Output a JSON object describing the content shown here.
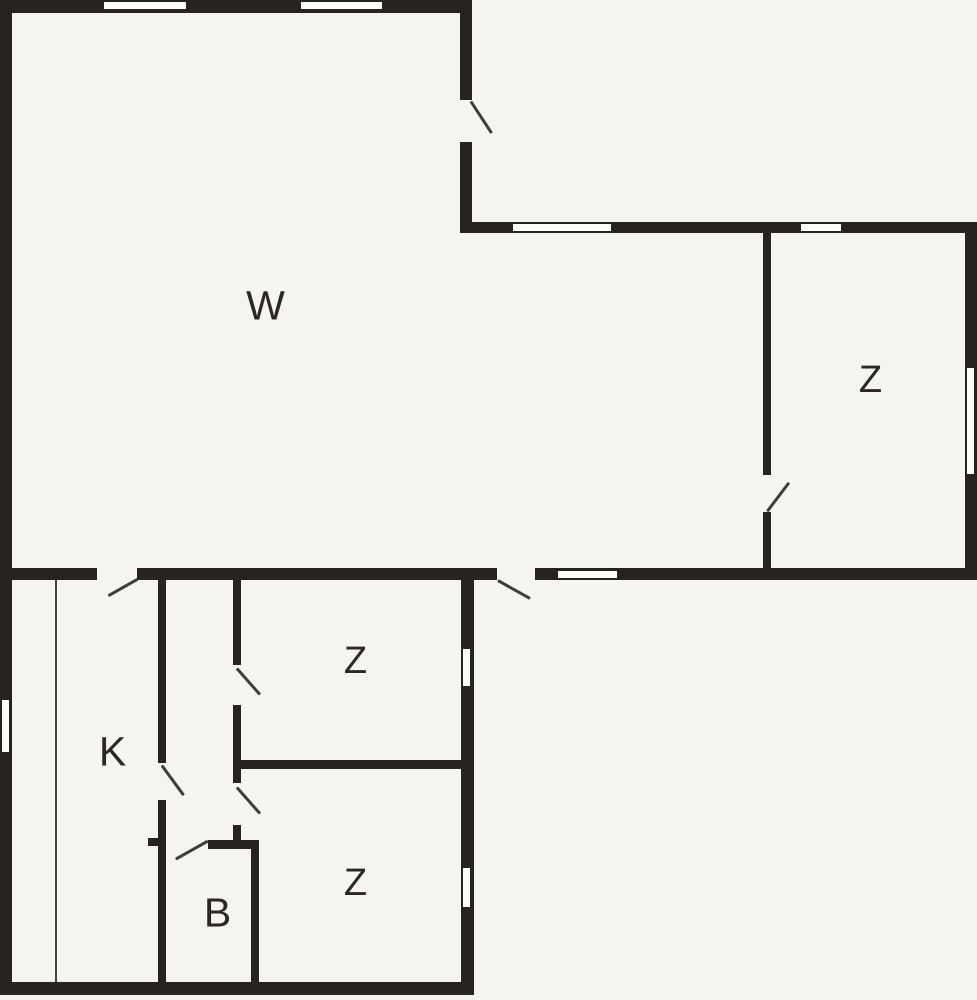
{
  "title": "Floor plan",
  "canvas": {
    "width": 977,
    "height": 1000
  },
  "colors": {
    "background": "#f5f4ef",
    "wall": "#272320",
    "window_fill": "#fdfdfa",
    "door_swing_line": "#3f3d38",
    "label_text": "#2b2723"
  },
  "rooms": [
    {
      "id": "w-room",
      "label": "W",
      "cx": 266,
      "cy": 306,
      "font_px": 41
    },
    {
      "id": "z-room-right",
      "label": "Z",
      "cx": 871,
      "cy": 380,
      "font_px": 38
    },
    {
      "id": "z-room-upper",
      "label": "Z",
      "cx": 356,
      "cy": 661,
      "font_px": 38
    },
    {
      "id": "z-room-lower",
      "label": "Z",
      "cx": 356,
      "cy": 883,
      "font_px": 38
    },
    {
      "id": "k-room",
      "label": "K",
      "cx": 113,
      "cy": 752,
      "font_px": 41
    },
    {
      "id": "b-room",
      "label": "B",
      "cx": 218,
      "cy": 913,
      "font_px": 41
    }
  ],
  "walls": [
    {
      "name": "top-exterior-wall",
      "x": 0,
      "y": 0,
      "w": 472,
      "h": 13
    },
    {
      "name": "left-exterior-wall",
      "x": 0,
      "y": 0,
      "w": 12,
      "h": 995
    },
    {
      "name": "bottom-exterior-wall",
      "x": 0,
      "y": 982,
      "w": 474,
      "h": 13
    },
    {
      "name": "lower-wing-right-wall",
      "x": 461,
      "y": 580,
      "w": 13,
      "h": 415
    },
    {
      "name": "entry-wall-above-door",
      "x": 460,
      "y": 0,
      "w": 12,
      "h": 100
    },
    {
      "name": "entry-wall-below-door",
      "x": 460,
      "y": 142,
      "w": 12,
      "h": 91
    },
    {
      "name": "right-wing-north-wall",
      "x": 460,
      "y": 222,
      "w": 517,
      "h": 11
    },
    {
      "name": "right-wing-east-wall",
      "x": 965,
      "y": 222,
      "w": 12,
      "h": 358
    },
    {
      "name": "south-wall-seg-1",
      "x": 12,
      "y": 568,
      "w": 85,
      "h": 12
    },
    {
      "name": "south-wall-seg-2",
      "x": 137,
      "y": 568,
      "w": 323,
      "h": 12
    },
    {
      "name": "south-wall-seg-3",
      "x": 460,
      "y": 568,
      "w": 37,
      "h": 12
    },
    {
      "name": "south-wall-seg-4",
      "x": 535,
      "y": 568,
      "w": 442,
      "h": 12
    },
    {
      "name": "z-right-partition-upper",
      "x": 763,
      "y": 233,
      "w": 8,
      "h": 242
    },
    {
      "name": "z-right-partition-lower",
      "x": 763,
      "y": 512,
      "w": 8,
      "h": 56
    },
    {
      "name": "hall-partition-top",
      "x": 233,
      "y": 580,
      "w": 8,
      "h": 85
    },
    {
      "name": "hall-partition-mid",
      "x": 233,
      "y": 705,
      "w": 8,
      "h": 78
    },
    {
      "name": "hall-partition-bottom",
      "x": 233,
      "y": 825,
      "w": 8,
      "h": 15
    },
    {
      "name": "z-divider-wall",
      "x": 241,
      "y": 760,
      "w": 220,
      "h": 9
    },
    {
      "name": "k-partition-upper",
      "x": 158,
      "y": 580,
      "w": 8,
      "h": 183
    },
    {
      "name": "k-b-partition-lower",
      "x": 158,
      "y": 800,
      "w": 8,
      "h": 185
    },
    {
      "name": "b-top-wall",
      "x": 208,
      "y": 840,
      "w": 51,
      "h": 9
    },
    {
      "name": "b-top-wall-stub",
      "x": 148,
      "y": 838,
      "w": 10,
      "h": 8
    },
    {
      "name": "b-right-wall",
      "x": 251,
      "y": 840,
      "w": 8,
      "h": 145
    }
  ],
  "windows": [
    {
      "name": "window-top-1",
      "x": 103,
      "y": 1,
      "w": 84,
      "h": 9
    },
    {
      "name": "window-top-2",
      "x": 300,
      "y": 1,
      "w": 83,
      "h": 9
    },
    {
      "name": "window-left",
      "x": 1,
      "y": 699,
      "w": 9,
      "h": 54
    },
    {
      "name": "window-north-1",
      "x": 512,
      "y": 223,
      "w": 100,
      "h": 9
    },
    {
      "name": "window-north-2",
      "x": 800,
      "y": 223,
      "w": 42,
      "h": 9
    },
    {
      "name": "window-east",
      "x": 966,
      "y": 367,
      "w": 9,
      "h": 108
    },
    {
      "name": "window-south",
      "x": 557,
      "y": 570,
      "w": 61,
      "h": 9
    },
    {
      "name": "window-lower-right-1",
      "x": 462,
      "y": 648,
      "w": 9,
      "h": 39
    },
    {
      "name": "window-lower-right-2",
      "x": 462,
      "y": 867,
      "w": 9,
      "h": 41
    }
  ],
  "door_swings": [
    {
      "name": "entry-door-swing",
      "x1": 471,
      "y1": 101,
      "x2": 492,
      "y2": 133
    },
    {
      "name": "w-to-k-door-swing",
      "x1": 138,
      "y1": 579,
      "x2": 108,
      "y2": 596
    },
    {
      "name": "south-exterior-door-swing",
      "x1": 498,
      "y1": 580,
      "x2": 530,
      "y2": 598
    },
    {
      "name": "z-right-door-swing",
      "x1": 767,
      "y1": 511,
      "x2": 789,
      "y2": 482
    },
    {
      "name": "z-upper-door-swing",
      "x1": 237,
      "y1": 668,
      "x2": 260,
      "y2": 694
    },
    {
      "name": "z-lower-door-swing",
      "x1": 237,
      "y1": 787,
      "x2": 260,
      "y2": 813
    },
    {
      "name": "k-door-swing",
      "x1": 162,
      "y1": 765,
      "x2": 184,
      "y2": 795
    },
    {
      "name": "b-door-swing",
      "x1": 208,
      "y1": 841,
      "x2": 176,
      "y2": 859
    }
  ],
  "thin_lines": [
    {
      "name": "k-closet-line",
      "x": 55,
      "y": 580,
      "w": 2,
      "h": 402
    }
  ]
}
